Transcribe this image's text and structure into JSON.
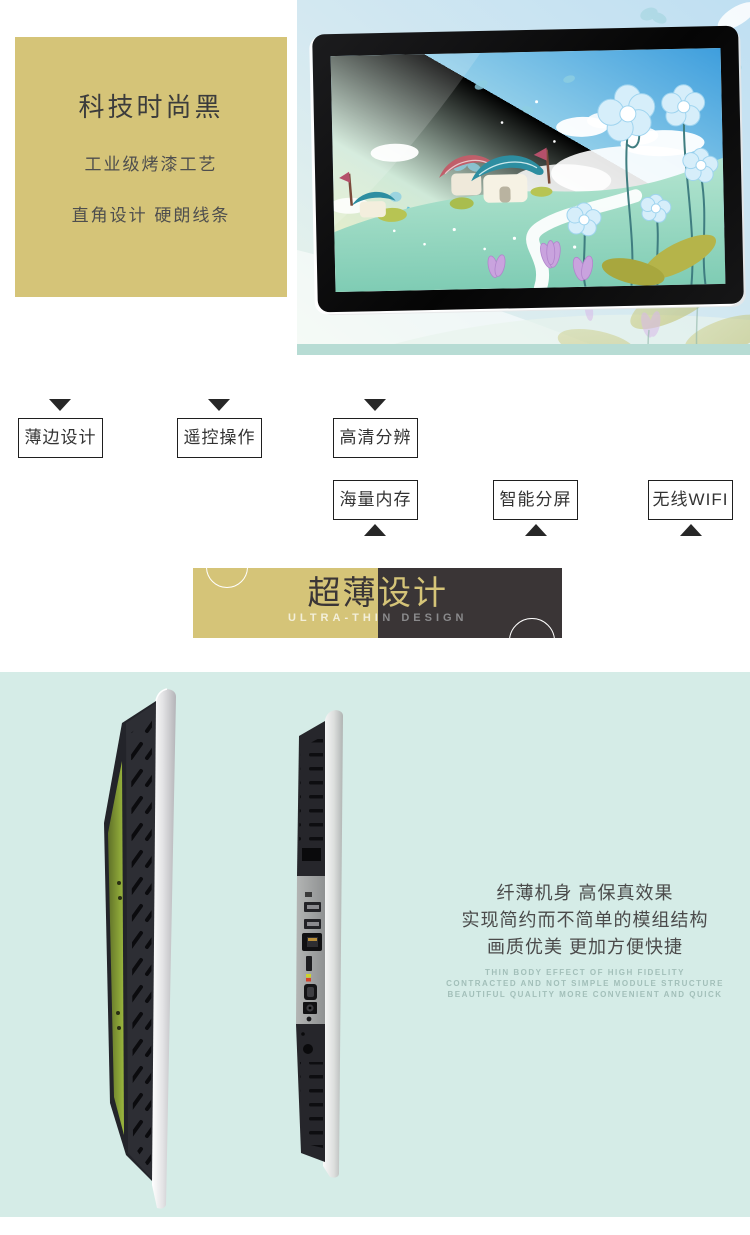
{
  "hero": {
    "title": "科技时尚黑",
    "line1": "工业级烤漆工艺",
    "line2": "直角设计 硬朗线条"
  },
  "features": {
    "row1": [
      "薄边设计",
      "遥控操作",
      "高清分辨"
    ],
    "row2": [
      "海量内存",
      "智能分屏",
      "无线WIFI"
    ]
  },
  "banner": {
    "title": "超薄设计",
    "subtitle": "ULTRA-THIN DESIGN"
  },
  "thin_section": {
    "cn_lines": [
      "纤薄机身 高保真效果",
      "实现简约而不简单的模组结构",
      "画质优美 更加方便快捷"
    ],
    "en_lines": [
      "THIN BODY EFFECT OF HIGH FIDELITY",
      "CONTRACTED AND NOT SIMPLE MODULE STRUCTURE",
      "BEAUTIFUL QUALITY MORE CONVENIENT AND QUICK"
    ]
  },
  "colors": {
    "khaki": "#d5c478",
    "dark": "#3a3536",
    "cyan_bg": "#d5ece7",
    "text_dark": "#3c3c3c"
  }
}
